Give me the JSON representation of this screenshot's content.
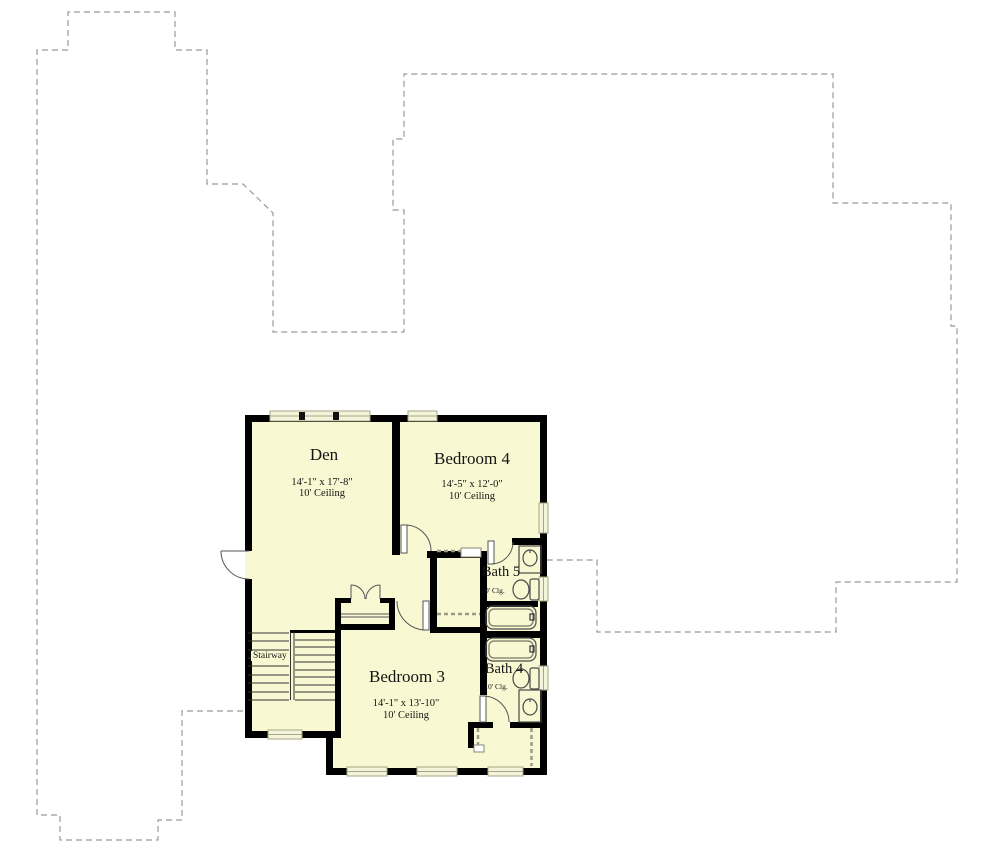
{
  "plan": {
    "type": "floor-plan",
    "colors": {
      "floor_fill": "#f8f8d2",
      "wall": "#000000",
      "lower_floor_outline": "#999999",
      "window_frame": "#a6a687",
      "window_fill": "#f4f4da",
      "fixture_stroke": "#4a4a4a"
    },
    "rooms": {
      "den": {
        "name": "Den",
        "dimensions": "14'-1\" x 17'-8\"",
        "ceiling": "10' Ceiling"
      },
      "bedroom4": {
        "name": "Bedroom 4",
        "dimensions": "14'-5\" x 12'-0\"",
        "ceiling": "10' Ceiling"
      },
      "bedroom3": {
        "name": "Bedroom 3",
        "dimensions": "14'-1\" x 13'-10\"",
        "ceiling": "10' Ceiling"
      },
      "bath5": {
        "name": "Bath 5",
        "ceiling": "10' Clg."
      },
      "bath4": {
        "name": "Bath 4",
        "ceiling": "10' Clg."
      },
      "stairway": {
        "name": "Stairway"
      }
    }
  }
}
